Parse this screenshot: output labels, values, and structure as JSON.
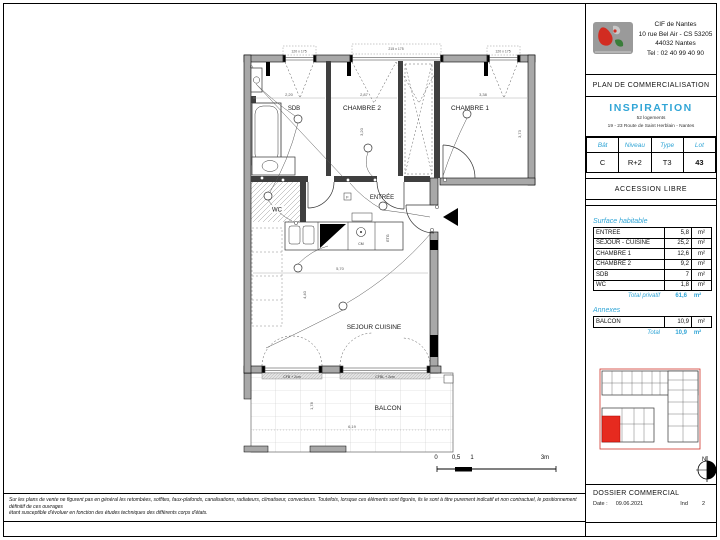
{
  "colors": {
    "accent": "#31a5d6",
    "red": "#e62a1f",
    "wall_gray": "#a8a8a8"
  },
  "titleblock": {
    "company": {
      "name": "CIF de Nantes",
      "address1": "10 rue Bel Air - CS 53205",
      "address2": "44032 Nantes",
      "phone": "Tel : 02 40 99 40 90"
    },
    "doc_type": "PLAN DE COMMERCIALISATION",
    "program": {
      "name": "INSPIRATION",
      "line1": "52 logements",
      "line2": "19 - 23 Route de Saint Herblain - Nantes"
    },
    "unit": {
      "headers": [
        "Bât",
        "Niveau",
        "Type",
        "Lot"
      ],
      "values": [
        "C",
        "R+2",
        "T3",
        "43"
      ]
    },
    "access": "ACCESSION LIBRE",
    "surfaces": {
      "title": "Surface habitable",
      "rows": [
        [
          "ENTREE",
          "5,8",
          "m²"
        ],
        [
          "SEJOUR - CUISINE",
          "25,2",
          "m²"
        ],
        [
          "CHAMBRE 1",
          "12,6",
          "m²"
        ],
        [
          "CHAMBRE 2",
          "9,2",
          "m²"
        ],
        [
          "SDB",
          "7",
          "m²"
        ],
        [
          "WC",
          "1,8",
          "m²"
        ]
      ],
      "total_label": "Total privatif",
      "total_value": "61,6",
      "total_unit": "m²"
    },
    "annexes": {
      "title": "Annexes",
      "rows": [
        [
          "BALCON",
          "10,9",
          "m²"
        ]
      ],
      "total_label": "Total",
      "total_value": "10,9",
      "total_unit": "m²"
    },
    "compass_n": "N",
    "dossier": {
      "title": "DOSSIER COMMERCIAL",
      "date_label": "Date :",
      "date": "09.06.2021",
      "ind_label": "Ind",
      "ind": "2"
    }
  },
  "plan": {
    "rooms": {
      "sdb": "SDB",
      "ch2": "CHAMBRE 2",
      "ch1": "CHAMBRE 1",
      "entree": "ENTRÉE",
      "wc": "WC",
      "sejour": "SEJOUR CUISINE",
      "balcon": "BALCON"
    },
    "dims": {
      "sdb_w": "2,20",
      "ch2_w": "2,87",
      "ch2_h": "3,20",
      "ch1_w": "3,38",
      "ch1_h": "3,73",
      "sej_w": "5,70",
      "sej_h": "4,40",
      "balc_w": "6,19",
      "balc_h": "1,78"
    },
    "windows": {
      "top": [
        "120 x 175",
        "215 x 175",
        "120 x 175"
      ],
      "bottom": [
        "CFB + 2cm",
        "CFBL + 2cm"
      ]
    },
    "kitchen": {
      "hob": "CM",
      "tall": "ETG"
    },
    "corner": "D.",
    "entree_box": "F"
  },
  "scalebar": {
    "t0": "0",
    "t05": "0,5",
    "t1": "1",
    "t3": "3m"
  },
  "disclaimer": {
    "line1": "Sur les plans de vente ne figurent pas en général les retombées, soffites, faux-plafonds, canalisations, radiateurs, climatiseur, convecteurs. Toutefois, lorsque ces éléments sont figurés, ils le sont à titre purement indicatif et non contractuel, le positionnement définitif de ces ouvrages",
    "line2": "étant susceptible d'évoluer en fonction des études techniques des différents corps d'états."
  }
}
